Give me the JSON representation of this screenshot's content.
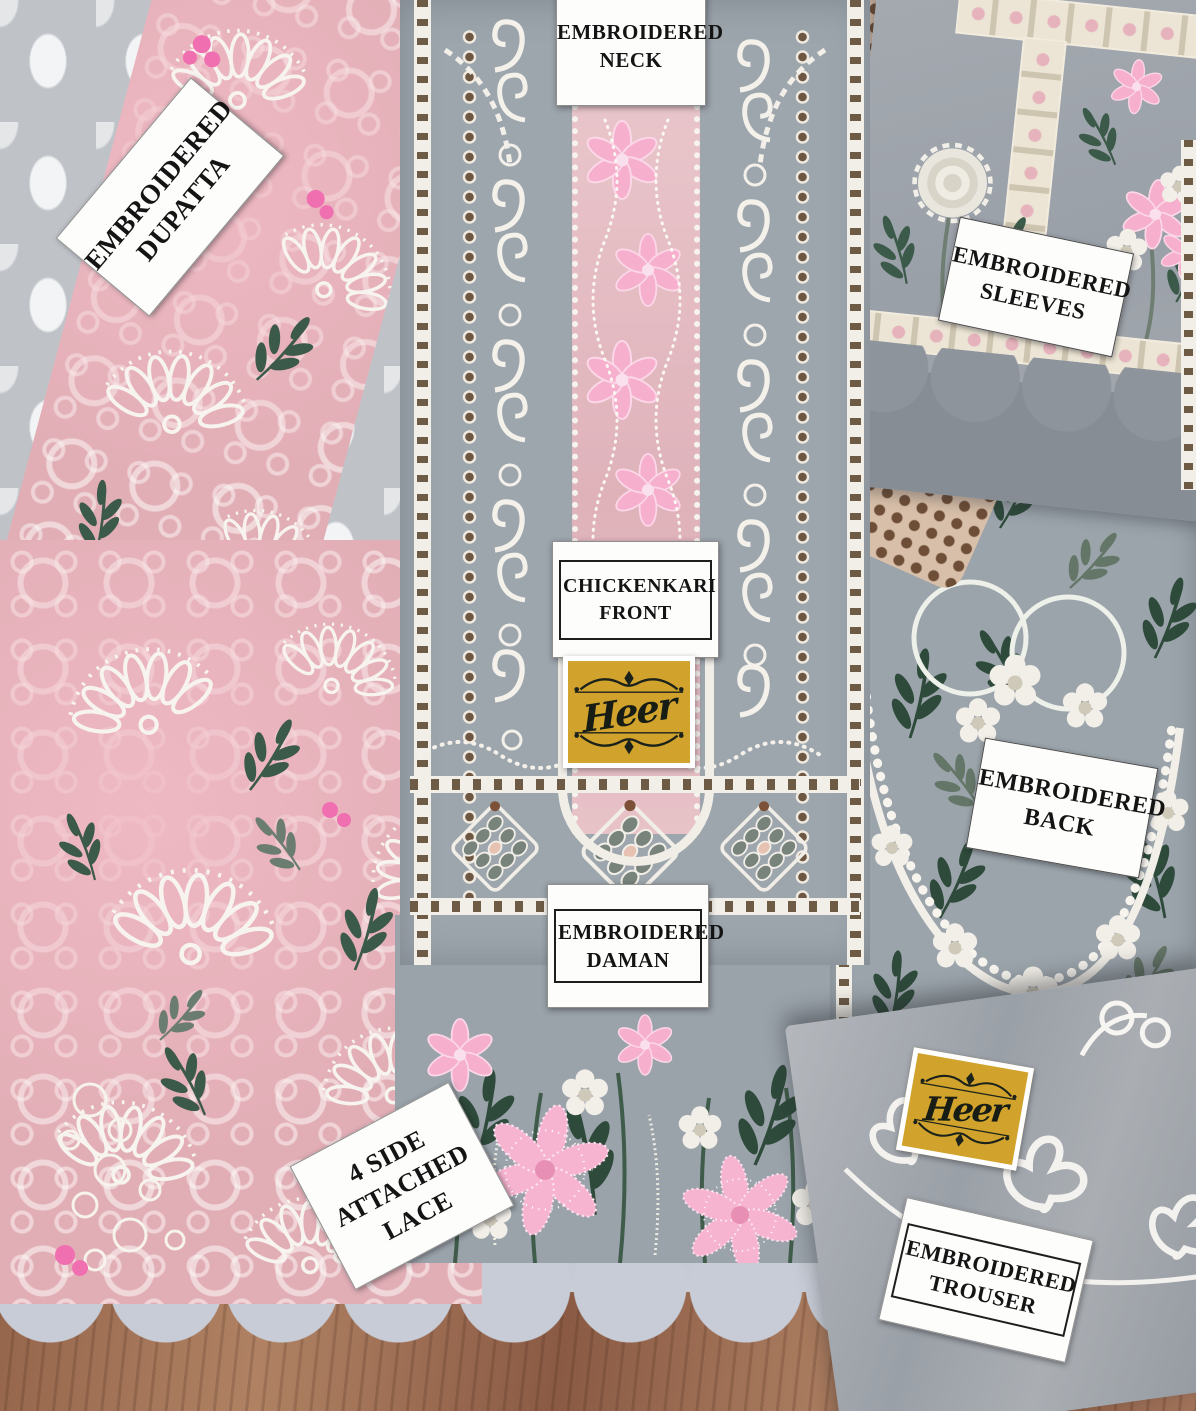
{
  "brand": {
    "name": "Heer",
    "badge_bg": "#d1a32c",
    "badge_border": "#ffffff",
    "badge_text_color": "#171d15"
  },
  "labels": {
    "dupatta": {
      "lines": [
        "EMBROIDERED",
        "DUPATTA"
      ]
    },
    "neck": {
      "lines": [
        "EMBROIDERED",
        "NECK"
      ]
    },
    "sleeves": {
      "lines": [
        "EMBROIDERED",
        "SLEEVES"
      ]
    },
    "front": {
      "lines": [
        "CHICKENKARI",
        "FRONT"
      ]
    },
    "back": {
      "lines": [
        "EMBROIDERED",
        "BACK"
      ]
    },
    "daman": {
      "lines": [
        "EMBROIDERED",
        "DAMAN"
      ]
    },
    "lace": {
      "lines": [
        "4 SIDE",
        "ATTACHED",
        "LACE"
      ]
    },
    "trouser": {
      "lines": [
        "EMBROIDERED",
        "TROUSER"
      ]
    }
  },
  "colors": {
    "label_bg": "#fdfdfc",
    "label_text": "#141414",
    "gray_fabric": "#9aa3ab",
    "pink_fabric": "#e2aeb6",
    "pink_flower": "#f6b4d1",
    "white_lace": "#f2efe8",
    "green_leaf": "#2e4a3b",
    "wood": "#a07157",
    "scallop_lace": "#c7ccd6"
  }
}
